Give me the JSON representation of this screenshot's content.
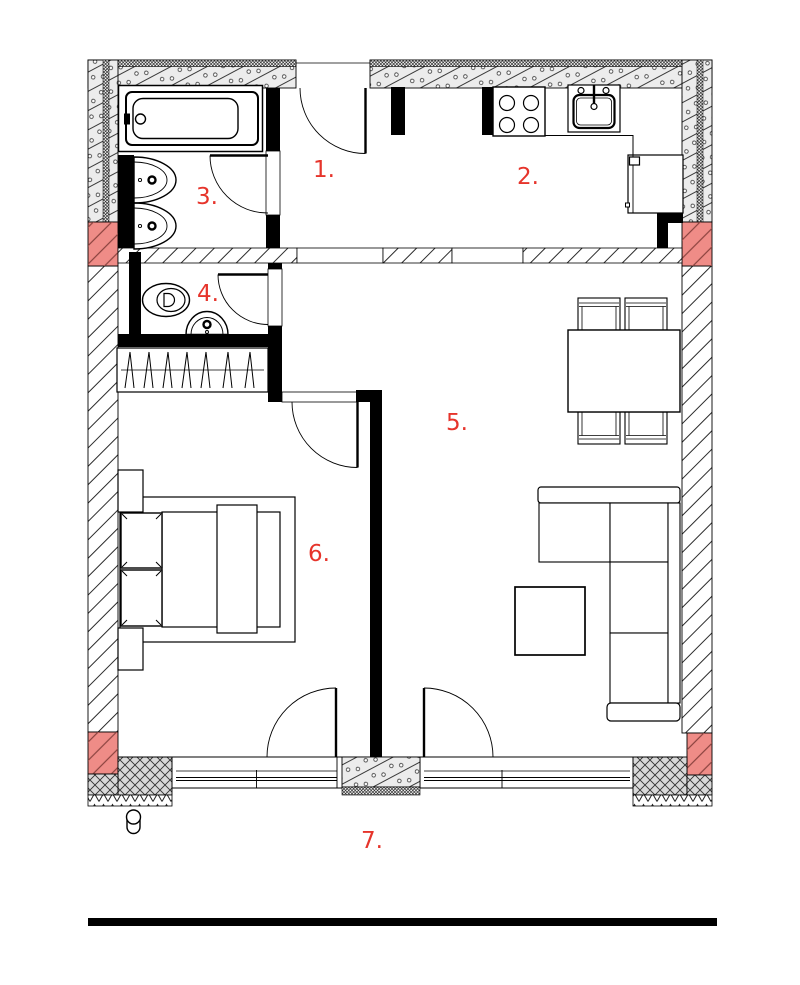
{
  "rooms": [
    {
      "label": "1."
    },
    {
      "label": "2."
    },
    {
      "label": "3."
    },
    {
      "label": "4."
    },
    {
      "label": "5."
    },
    {
      "label": "6."
    },
    {
      "label": "7."
    }
  ],
  "colors": {
    "room_label": "#e6342b",
    "structure_highlight": "#ef8c87"
  }
}
